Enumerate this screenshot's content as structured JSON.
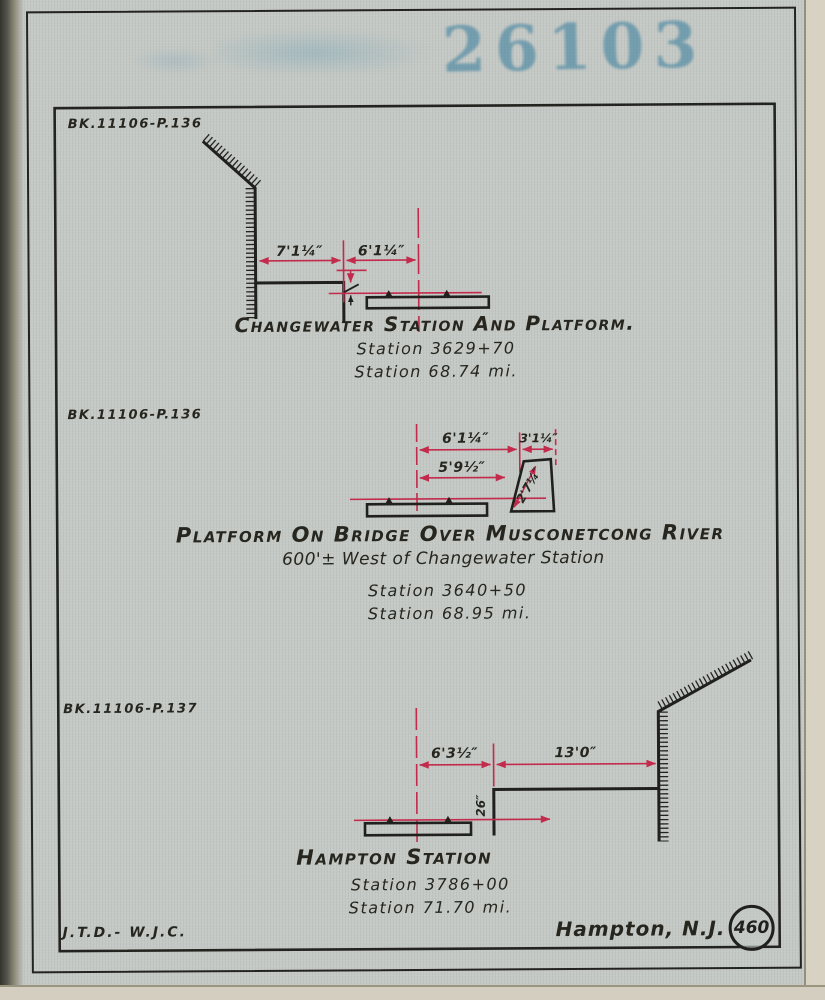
{
  "stamp": {
    "number": "26103"
  },
  "diagrams": {
    "changewater": {
      "book_ref": "BK.11106-P.136",
      "title": "Changewater Station And Platform.",
      "station": "Station 3629+70",
      "milepost": "Station 68.74 mi.",
      "dim_wall_to_platform_edge": "7'1¼″",
      "dim_platform_edge_to_track": "6'1¼″"
    },
    "bridge": {
      "book_ref": "BK.11106-P.136",
      "title": "Platform On Bridge Over Musconetcong River",
      "subtitle": "600'± West of Changewater Station",
      "station": "Station 3640+50",
      "milepost": "Station 68.95 mi.",
      "dim_track_to_platform": "6'1¼″",
      "dim_platform_width": "3'1¼″",
      "dim_track_to_slope": "5'9½″",
      "dim_slope_length": "2'7¼″"
    },
    "hampton": {
      "book_ref": "BK.11106-P.137",
      "title": "Hampton Station",
      "station": "Station 3786+00",
      "milepost": "Station 71.70 mi.",
      "dim_track_to_platform_edge": "6'3½″",
      "dim_platform_edge_to_wall": "13'0″",
      "dim_platform_height": "26″"
    }
  },
  "footer": {
    "credit": "J.T.D.- W.J.C.",
    "location": "Hampton, N.J.",
    "sheet_number": "460"
  },
  "colors": {
    "paper": "#c5c9c5",
    "ink": "#20201e",
    "dimension_red": "#c22b4c",
    "stamp_blue": "#4e93ae"
  }
}
